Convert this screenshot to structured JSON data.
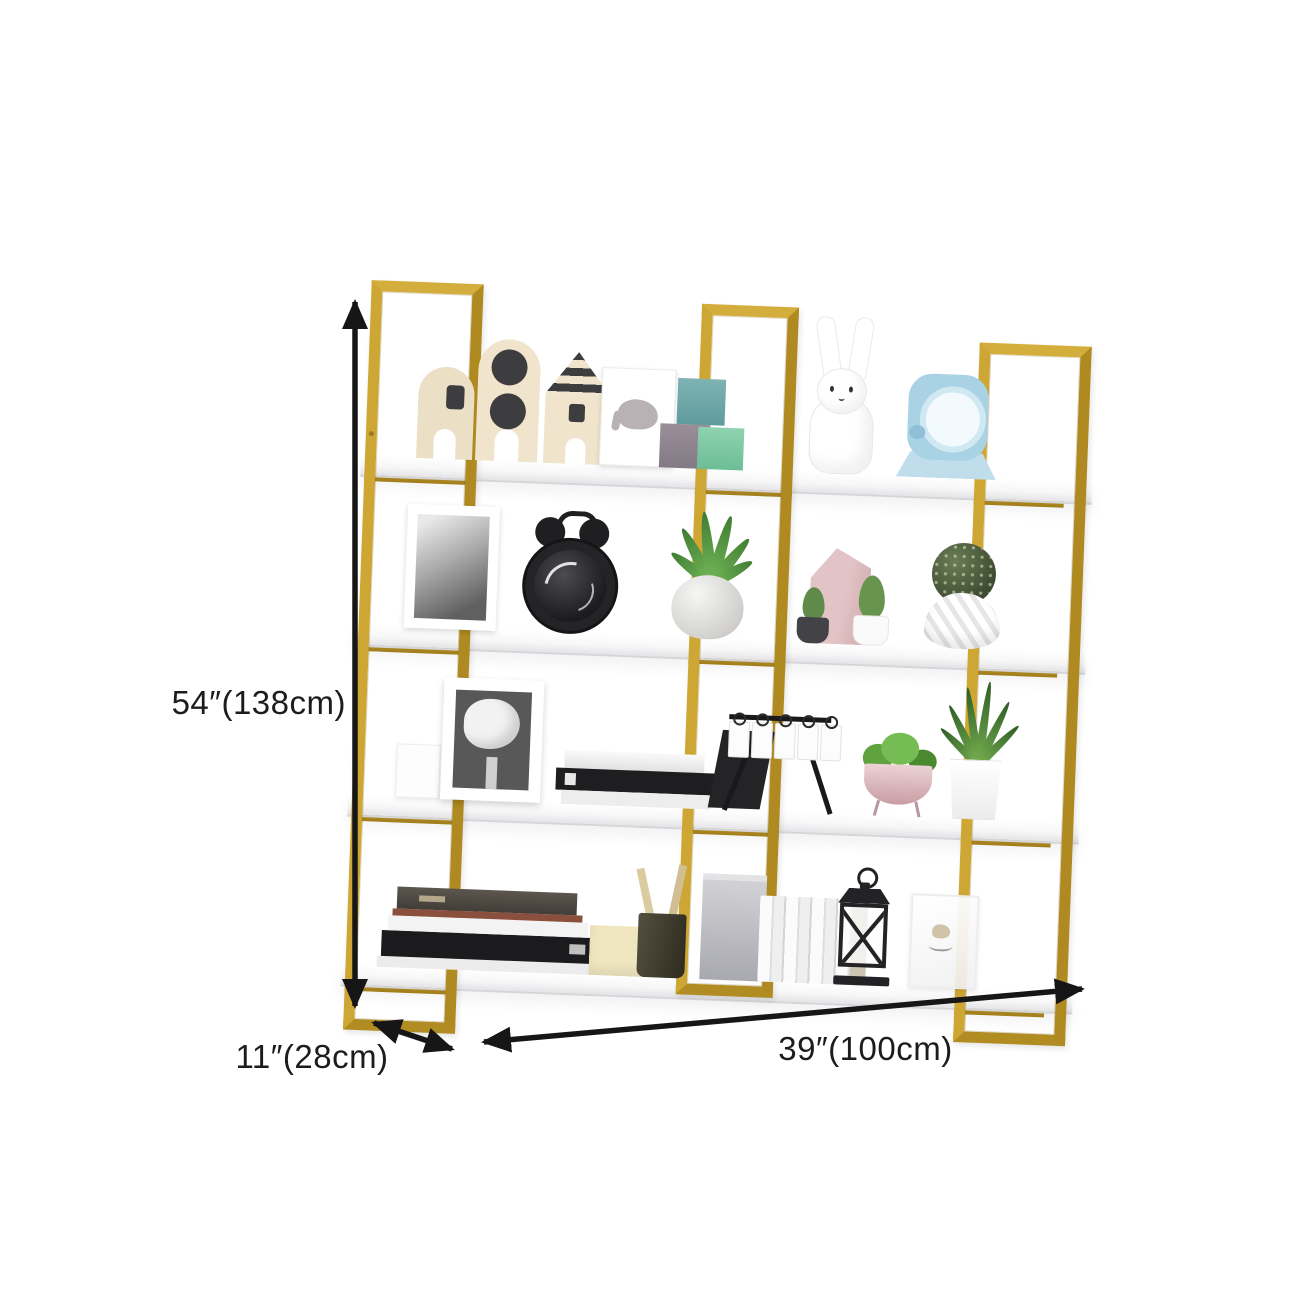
{
  "dimensions": {
    "height_label": "54″(138cm)",
    "depth_label": "11″(28cm)",
    "width_label": "39″(100cm)"
  },
  "colors": {
    "frame_gold": "#C7A233",
    "shelf_white": "#FBFBFC",
    "annotation_black": "#1C1C1C",
    "background": "#FFFFFF"
  },
  "product": {
    "kind": "wall-mounted gold metal bookshelf with 4 white shelves",
    "shelves": [
      {
        "items": [
          "toy-house-arch",
          "toy-house-circles",
          "toy-house-striped-roof",
          "elephant-picture-frame",
          "stacking-cubes",
          "rabbit-figurine",
          "blue-table-fan"
        ]
      },
      {
        "items": [
          "portrait-photo-frame",
          "black-alarm-clock",
          "potted-green-plant",
          "mini-cactus-black-pot",
          "pink-house-decor",
          "mini-cactus-white-pot",
          "cactus-ball-in-swirl-vase"
        ]
      },
      {
        "items": [
          "small-white-box",
          "rose-photo-frame",
          "book-stack",
          "black-card-display-rack",
          "pink-bowl-planter",
          "white-pot-succulent"
        ]
      },
      {
        "items": [
          "large-book-stack",
          "cream-file-holder",
          "pencil-cup",
          "grey-storage-box",
          "white-book-row",
          "tan-book",
          "black-lantern",
          "clear-photo-frame"
        ]
      }
    ]
  }
}
